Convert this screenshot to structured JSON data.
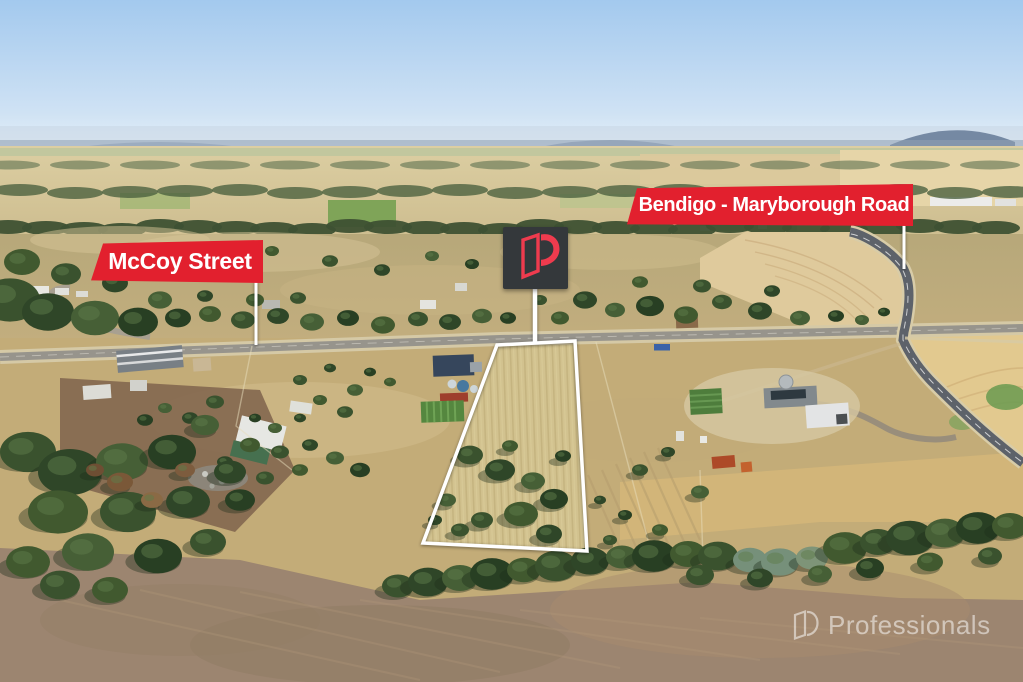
{
  "labels": {
    "mccoy": {
      "text": "McCoy Street",
      "bg": "#e2202e",
      "color": "#ffffff"
    },
    "bendigo": {
      "text": "Bendigo - Maryborough Road",
      "bg": "#e2202e",
      "color": "#ffffff"
    }
  },
  "marker": {
    "logo": "professionals-p-door-logo",
    "bg": "#34383b",
    "accent": "#ef3b4e"
  },
  "boundary": {
    "color": "#ffffff"
  },
  "watermark": {
    "text": "Professionals",
    "color": "#ffffff"
  }
}
